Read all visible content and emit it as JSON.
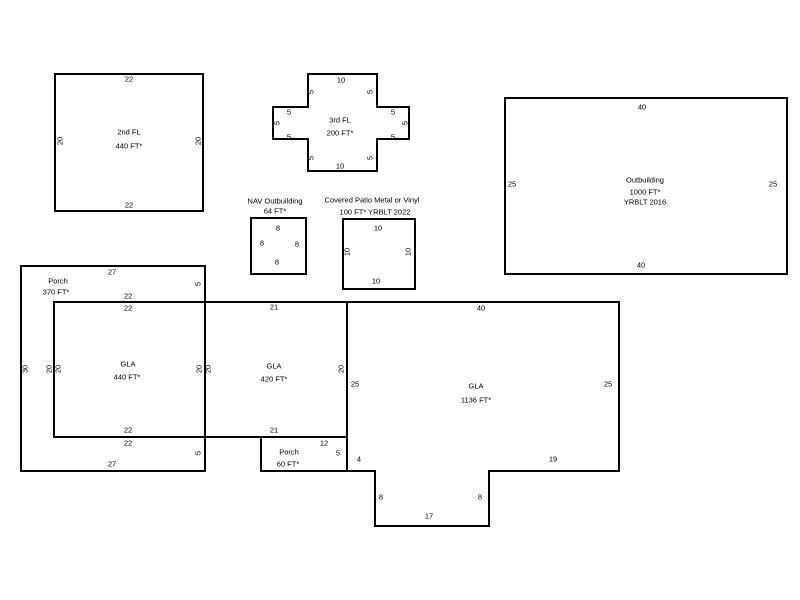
{
  "canvas": {
    "width": 800,
    "height": 600,
    "background": "#ffffff",
    "stroke_color": "#000000",
    "stroke_width": 2,
    "label_color": "#000000"
  },
  "shapes": [
    {
      "name": "second-floor-outline",
      "points": [
        [
          55,
          74
        ],
        [
          203,
          74
        ],
        [
          203,
          211
        ],
        [
          55,
          211
        ]
      ]
    },
    {
      "name": "third-floor-outline",
      "points": [
        [
          308,
          74
        ],
        [
          377,
          74
        ],
        [
          377,
          107
        ],
        [
          409,
          107
        ],
        [
          409,
          139
        ],
        [
          377,
          139
        ],
        [
          377,
          171
        ],
        [
          308,
          171
        ],
        [
          308,
          139
        ],
        [
          273,
          139
        ],
        [
          273,
          107
        ],
        [
          308,
          107
        ]
      ]
    },
    {
      "name": "outbuilding-outline",
      "points": [
        [
          505,
          98
        ],
        [
          787,
          98
        ],
        [
          787,
          274
        ],
        [
          505,
          274
        ]
      ]
    },
    {
      "name": "nav-outbuilding-outline",
      "points": [
        [
          251,
          218
        ],
        [
          306,
          218
        ],
        [
          306,
          274
        ],
        [
          251,
          274
        ]
      ]
    },
    {
      "name": "covered-patio-outline",
      "points": [
        [
          343,
          219
        ],
        [
          415,
          219
        ],
        [
          415,
          289
        ],
        [
          343,
          289
        ]
      ]
    },
    {
      "name": "porch-370-outline",
      "points": [
        [
          21,
          266
        ],
        [
          205,
          266
        ],
        [
          205,
          471
        ],
        [
          21,
          471
        ]
      ]
    },
    {
      "name": "gla-440-outline",
      "points": [
        [
          54,
          302
        ],
        [
          205,
          302
        ],
        [
          205,
          437
        ],
        [
          54,
          437
        ]
      ]
    },
    {
      "name": "gla-420-outline",
      "points": [
        [
          205,
          302
        ],
        [
          347,
          302
        ],
        [
          347,
          437
        ],
        [
          205,
          437
        ]
      ]
    },
    {
      "name": "gla-1136-outline",
      "points": [
        [
          347,
          302
        ],
        [
          619,
          302
        ],
        [
          619,
          471
        ],
        [
          489,
          471
        ],
        [
          489,
          526
        ],
        [
          375,
          526
        ],
        [
          375,
          471
        ],
        [
          347,
          471
        ]
      ]
    },
    {
      "name": "porch-60-outline",
      "points": [
        [
          261,
          437
        ],
        [
          347,
          437
        ],
        [
          347,
          471
        ],
        [
          261,
          471
        ]
      ]
    }
  ],
  "labels": [
    {
      "name": "second-floor-dim-top",
      "text": "22",
      "x": 129,
      "y": 79,
      "rot": false
    },
    {
      "name": "second-floor-dim-bottom",
      "text": "22",
      "x": 129,
      "y": 205,
      "rot": false
    },
    {
      "name": "second-floor-dim-left",
      "text": "20",
      "x": 60,
      "y": 141,
      "rot": true
    },
    {
      "name": "second-floor-dim-right",
      "text": "20",
      "x": 198,
      "y": 141,
      "rot": true
    },
    {
      "name": "second-floor-title",
      "text": "2nd FL",
      "x": 129,
      "y": 132,
      "rot": false
    },
    {
      "name": "second-floor-area",
      "text": "440 FT*",
      "x": 129,
      "y": 146,
      "rot": false
    },
    {
      "name": "third-floor-dim-top",
      "text": "10",
      "x": 341,
      "y": 80,
      "rot": false
    },
    {
      "name": "third-floor-dim-bottom",
      "text": "10",
      "x": 340,
      "y": 166,
      "rot": false
    },
    {
      "name": "third-floor-title",
      "text": "3rd FL",
      "x": 340,
      "y": 120,
      "rot": false
    },
    {
      "name": "third-floor-area",
      "text": "200 FT*",
      "x": 340,
      "y": 133,
      "rot": false
    },
    {
      "name": "third-floor-dim-col-tl",
      "text": "5",
      "x": 311,
      "y": 92,
      "rot": true
    },
    {
      "name": "third-floor-dim-col-tr",
      "text": "5",
      "x": 370,
      "y": 92,
      "rot": true
    },
    {
      "name": "third-floor-dim-col-bl",
      "text": "5",
      "x": 311,
      "y": 158,
      "rot": true
    },
    {
      "name": "third-floor-dim-col-br",
      "text": "5",
      "x": 370,
      "y": 158,
      "rot": true
    },
    {
      "name": "third-floor-dim-left-arm-top",
      "text": "5",
      "x": 289,
      "y": 112,
      "rot": false
    },
    {
      "name": "third-floor-dim-left-arm-bot",
      "text": "5",
      "x": 289,
      "y": 137,
      "rot": false
    },
    {
      "name": "third-floor-dim-right-arm-top",
      "text": "5",
      "x": 393,
      "y": 112,
      "rot": false
    },
    {
      "name": "third-floor-dim-right-arm-bot",
      "text": "5",
      "x": 393,
      "y": 137,
      "rot": false
    },
    {
      "name": "third-floor-dim-far-left",
      "text": "5",
      "x": 277,
      "y": 123,
      "rot": true
    },
    {
      "name": "third-floor-dim-far-right",
      "text": "5",
      "x": 405,
      "y": 123,
      "rot": true
    },
    {
      "name": "outbuilding-dim-top",
      "text": "40",
      "x": 642,
      "y": 107,
      "rot": false
    },
    {
      "name": "outbuilding-dim-bottom",
      "text": "40",
      "x": 641,
      "y": 265,
      "rot": false
    },
    {
      "name": "outbuilding-dim-left",
      "text": "25",
      "x": 512,
      "y": 184,
      "rot": false
    },
    {
      "name": "outbuilding-dim-right",
      "text": "25",
      "x": 773,
      "y": 184,
      "rot": false
    },
    {
      "name": "outbuilding-title",
      "text": "Outbuilding",
      "x": 645,
      "y": 180,
      "rot": false
    },
    {
      "name": "outbuilding-area",
      "text": "1000 FT*",
      "x": 645,
      "y": 192,
      "rot": false
    },
    {
      "name": "outbuilding-yrblt",
      "text": "YRBLT 2016",
      "x": 645,
      "y": 202,
      "rot": false
    },
    {
      "name": "nav-outbuilding-title",
      "text": "NAV Outbuilding",
      "x": 275,
      "y": 201,
      "rot": false
    },
    {
      "name": "nav-outbuilding-area",
      "text": "64 FT*",
      "x": 275,
      "y": 211,
      "rot": false
    },
    {
      "name": "nav-outbuilding-dim-top",
      "text": "8",
      "x": 278,
      "y": 228,
      "rot": false
    },
    {
      "name": "nav-outbuilding-dim-left",
      "text": "8",
      "x": 262,
      "y": 243,
      "rot": false
    },
    {
      "name": "nav-outbuilding-dim-right",
      "text": "8",
      "x": 297,
      "y": 244,
      "rot": false
    },
    {
      "name": "nav-outbuilding-dim-bottom",
      "text": "8",
      "x": 277,
      "y": 262,
      "rot": false
    },
    {
      "name": "covered-patio-title",
      "text": "Covered Patio Metal or Vinyl",
      "x": 372,
      "y": 200,
      "rot": false
    },
    {
      "name": "covered-patio-area-yrblt",
      "text": "100 FT*   YRBLT 2022",
      "x": 375,
      "y": 212,
      "rot": false
    },
    {
      "name": "covered-patio-dim-top",
      "text": "10",
      "x": 378,
      "y": 228,
      "rot": false
    },
    {
      "name": "covered-patio-dim-bottom",
      "text": "10",
      "x": 376,
      "y": 281,
      "rot": false
    },
    {
      "name": "covered-patio-dim-left",
      "text": "10",
      "x": 347,
      "y": 252,
      "rot": true
    },
    {
      "name": "covered-patio-dim-right",
      "text": "10",
      "x": 408,
      "y": 252,
      "rot": true
    },
    {
      "name": "porch-370-title",
      "text": "Porch",
      "x": 58,
      "y": 281,
      "rot": false
    },
    {
      "name": "porch-370-area",
      "text": "370 FT*",
      "x": 56,
      "y": 292,
      "rot": false
    },
    {
      "name": "porch-370-dim-top",
      "text": "27",
      "x": 112,
      "y": 272,
      "rot": false
    },
    {
      "name": "porch-370-dim-bottom",
      "text": "27",
      "x": 112,
      "y": 464,
      "rot": false
    },
    {
      "name": "porch-370-dim-left",
      "text": "30",
      "x": 25,
      "y": 369,
      "rot": true
    },
    {
      "name": "porch-370-dim-right-top",
      "text": "5",
      "x": 198,
      "y": 284,
      "rot": true
    },
    {
      "name": "porch-370-dim-right-bot",
      "text": "5",
      "x": 198,
      "y": 453,
      "rot": true
    },
    {
      "name": "porch-370-dim-inner-top",
      "text": "22",
      "x": 128,
      "y": 296,
      "rot": false
    },
    {
      "name": "porch-370-dim-inner-bot",
      "text": "22",
      "x": 128,
      "y": 443,
      "rot": false
    },
    {
      "name": "porch-370-dim-inner-left",
      "text": "20",
      "x": 49,
      "y": 369,
      "rot": true
    },
    {
      "name": "gla-440-title",
      "text": "GLA",
      "x": 128,
      "y": 364,
      "rot": false
    },
    {
      "name": "gla-440-area",
      "text": "440 FT*",
      "x": 127,
      "y": 377,
      "rot": false
    },
    {
      "name": "gla-440-dim-top",
      "text": "22",
      "x": 128,
      "y": 308,
      "rot": false
    },
    {
      "name": "gla-440-dim-bottom",
      "text": "22",
      "x": 128,
      "y": 430,
      "rot": false
    },
    {
      "name": "gla-440-dim-left",
      "text": "20",
      "x": 58,
      "y": 369,
      "rot": true
    },
    {
      "name": "gla-440-dim-right",
      "text": "20",
      "x": 199,
      "y": 369,
      "rot": true
    },
    {
      "name": "gla-420-title",
      "text": "GLA",
      "x": 274,
      "y": 366,
      "rot": false
    },
    {
      "name": "gla-420-area",
      "text": "420 FT*",
      "x": 274,
      "y": 379,
      "rot": false
    },
    {
      "name": "gla-420-dim-top",
      "text": "21",
      "x": 274,
      "y": 307,
      "rot": false
    },
    {
      "name": "gla-420-dim-bottom",
      "text": "21",
      "x": 274,
      "y": 430,
      "rot": false
    },
    {
      "name": "gla-420-dim-left",
      "text": "20",
      "x": 208,
      "y": 369,
      "rot": true
    },
    {
      "name": "gla-420-dim-right",
      "text": "20",
      "x": 341,
      "y": 369,
      "rot": true
    },
    {
      "name": "gla-1136-title",
      "text": "GLA",
      "x": 476,
      "y": 386,
      "rot": false
    },
    {
      "name": "gla-1136-area",
      "text": "1136 FT*",
      "x": 476,
      "y": 400,
      "rot": false
    },
    {
      "name": "gla-1136-dim-top",
      "text": "40",
      "x": 481,
      "y": 308,
      "rot": false
    },
    {
      "name": "gla-1136-dim-left",
      "text": "25",
      "x": 355,
      "y": 384,
      "rot": false
    },
    {
      "name": "gla-1136-dim-right",
      "text": "25",
      "x": 608,
      "y": 384,
      "rot": false
    },
    {
      "name": "gla-1136-dim-bot-left",
      "text": "4",
      "x": 359,
      "y": 459,
      "rot": false
    },
    {
      "name": "gla-1136-dim-bot-right",
      "text": "19",
      "x": 553,
      "y": 459,
      "rot": false
    },
    {
      "name": "gla-1136-dim-notch-left",
      "text": "8",
      "x": 381,
      "y": 497,
      "rot": false
    },
    {
      "name": "gla-1136-dim-notch-right",
      "text": "8",
      "x": 480,
      "y": 497,
      "rot": false
    },
    {
      "name": "gla-1136-dim-notch-bot",
      "text": "17",
      "x": 429,
      "y": 516,
      "rot": false
    },
    {
      "name": "porch-60-title",
      "text": "Porch",
      "x": 289,
      "y": 452,
      "rot": false
    },
    {
      "name": "porch-60-area",
      "text": "60 FT*",
      "x": 288,
      "y": 464,
      "rot": false
    },
    {
      "name": "porch-60-dim-top",
      "text": "12",
      "x": 324,
      "y": 443,
      "rot": false
    },
    {
      "name": "porch-60-dim-right",
      "text": "5",
      "x": 338,
      "y": 453,
      "rot": false
    }
  ]
}
